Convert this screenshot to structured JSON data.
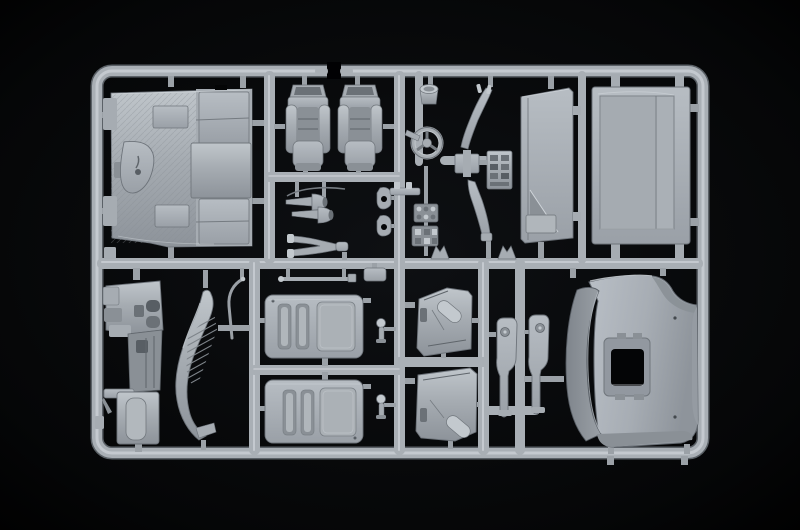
{
  "scene": {
    "type": "photograph",
    "subject": "Injection-moulded plastic model kit sprue (runner) holding truck cab parts",
    "material": "light grey polystyrene",
    "background": "black studio surface",
    "layout": "rounded rectangular runner frame, two rows of compartments divided by cross runners"
  },
  "colors": {
    "background": "#010103",
    "vignette": "#0e1013",
    "rail_base": "#a9afb5",
    "rail_highlight": "#c9ced3",
    "rail_shadow": "#5b6167",
    "part_light": "#c3c9ce",
    "part_mid": "#a6acb2",
    "part_dark": "#8a9096",
    "part_deep": "#6b7177",
    "recess": "#585e64",
    "hole_black": "#040506"
  },
  "sprue": {
    "frame_shape": "rounded rectangle with a moulding gap in the top rail",
    "rows": 2,
    "top_row_parts": 15,
    "bottom_row_parts": 12
  },
  "parts": {
    "cab_floor": {
      "label": "Cab floor with rear wall panels and engine tunnel"
    },
    "seat_left": {
      "label": "Driver seat"
    },
    "seat_right": {
      "label": "Passenger seat"
    },
    "air_horns": {
      "label": "Pair of trumpet air horns"
    },
    "mirror_fork": {
      "label": "Forked mirror bracket"
    },
    "small_brackets": {
      "label": "Two eyelet brackets"
    },
    "filter_cup": {
      "label": "Cylindrical cup part"
    },
    "steering_wheel": {
      "label": "Steering wheel with column"
    },
    "lever_upper": {
      "label": "Long control lever, upper"
    },
    "lever_lower": {
      "label": "Long control lever, lower"
    },
    "gauge_panel": {
      "label": "Instrument cluster plate"
    },
    "mounting_bracket": {
      "label": "Studded mounting bracket"
    },
    "switch_clusters": {
      "label": "Small switch clusters"
    },
    "retaining_clips": {
      "label": "Two forked retaining clips"
    },
    "curtain_panel": {
      "label": "Cab rear curtain panel with fold"
    },
    "rear_panel": {
      "label": "Large cab rear panel"
    },
    "dashboard": {
      "label": "Dashboard and console assembly"
    },
    "trim_rod": {
      "label": "Thin curved trim rod"
    },
    "fender_panel": {
      "label": "Curved side fairing with vent louvres"
    },
    "bunk_upper": {
      "label": "Sleeper bunk panel, upper"
    },
    "bunk_lower": {
      "label": "Sleeper bunk panel, lower"
    },
    "step_rod": {
      "label": "Thin step rod"
    },
    "small_box": {
      "label": "Small box bracket"
    },
    "pedals": {
      "label": "Two round-pad pedal parts"
    },
    "door_card_upper": {
      "label": "Door interior card, upper"
    },
    "door_card_lower": {
      "label": "Door interior card, lower"
    },
    "pillar_trims": {
      "label": "Two pillar trim strips with bosses"
    },
    "roof_panel": {
      "label": "Cab roof with open sunroof hatch"
    }
  }
}
